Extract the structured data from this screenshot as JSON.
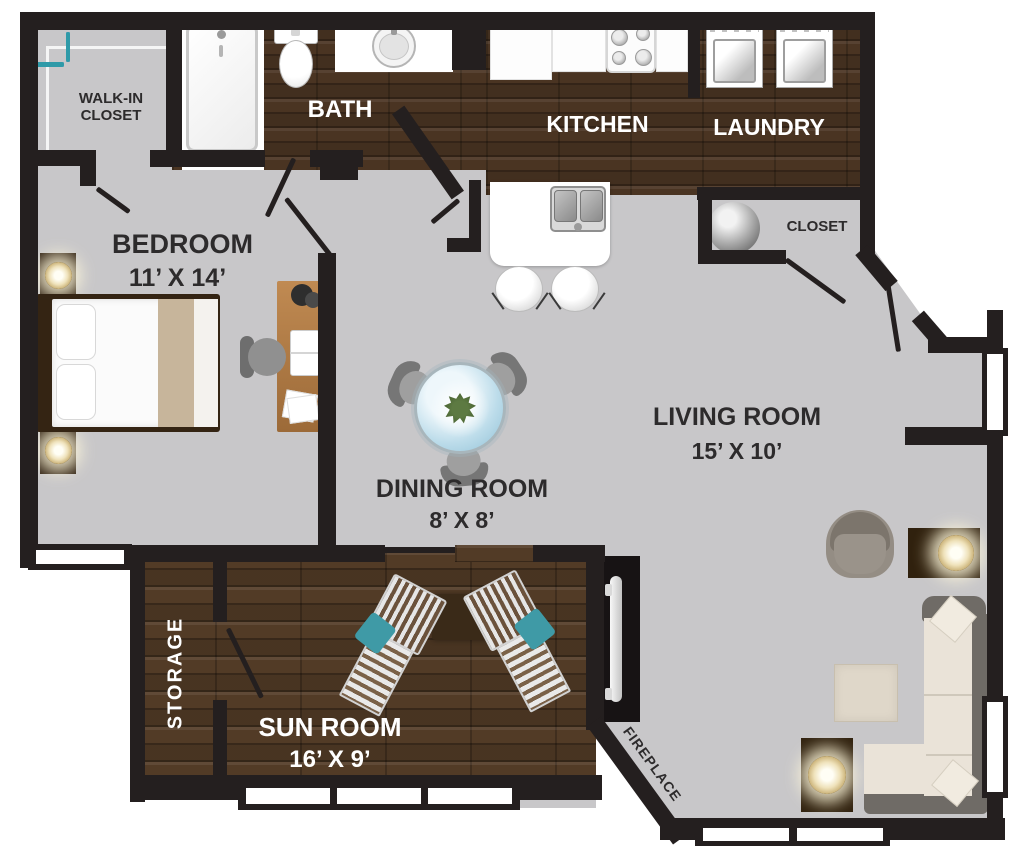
{
  "rooms": {
    "walk_in_closet": {
      "label_line1": "WALK-IN",
      "label_line2": "CLOSET"
    },
    "bath": {
      "label": "BATH"
    },
    "kitchen": {
      "label": "KITCHEN"
    },
    "laundry": {
      "label": "LAUNDRY"
    },
    "closet": {
      "label": "CLOSET"
    },
    "bedroom": {
      "label": "BEDROOM",
      "dimensions": "11’ X 14’"
    },
    "dining_room": {
      "label": "DINING ROOM",
      "dimensions": "8’ X 8’"
    },
    "living_room": {
      "label": "LIVING ROOM",
      "dimensions": "15’ X 10’"
    },
    "storage": {
      "label": "STORAGE"
    },
    "sun_room": {
      "label": "SUN ROOM",
      "dimensions": "16’ X 9’"
    },
    "fireplace": {
      "label": "FIREPLACE"
    }
  },
  "colors": {
    "wall": "#241f1f",
    "floor_gray": "#c8c7c9",
    "wood_dark": "#4a3422",
    "label_dark": "#2d2b2c",
    "label_light": "#ffffff",
    "pillow_teal": "#3f9aa6",
    "lamp_glow": "#fff6d8",
    "table_glass": "#bcdcea"
  },
  "closet_racks": {
    "top_rack_colors": [
      "#8f6f50",
      "#f2a233",
      "#f2a233",
      "#bf9468",
      "#bf9468",
      "#e8c696",
      "#83888f",
      "#83888f",
      "#e02a2a",
      "#e02a2a",
      "#9fb9ca",
      "#6f93ad",
      "#2f6fb5",
      "#2f6fb5",
      "#7fc8ea",
      "#2f9aa8"
    ],
    "side_rack_colors": [
      "#f2a233",
      "#8f6f50",
      "#f5c896",
      "#7e8288",
      "#e02a2a",
      "#8da0ad",
      "#2f6fb5",
      "#35aac8",
      "#8fd4f0",
      "#2f9aa8"
    ]
  }
}
